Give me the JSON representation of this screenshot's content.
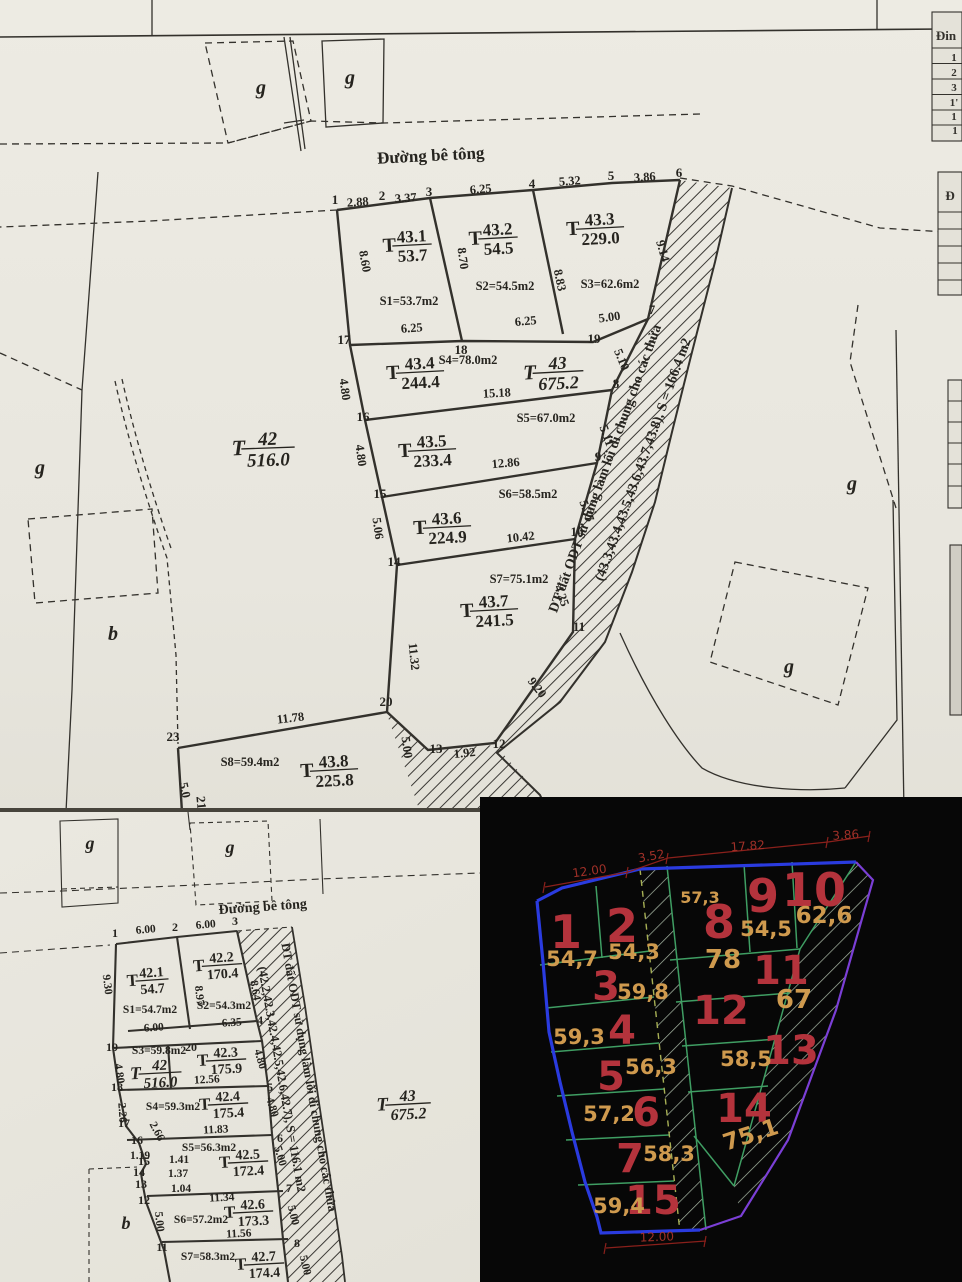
{
  "top_map": {
    "road": "Đường bê tông",
    "note1": "DT đất ODT sử dụng làm lối đi chung cho các thửa",
    "note2": "(43.3,43.4,43.5,43.6,43.7,43.8), S = 166.4 m2",
    "letters": [
      {
        "t": "g",
        "x": 261,
        "y": 94
      },
      {
        "t": "g",
        "x": 350,
        "y": 84
      },
      {
        "t": "g",
        "x": 40,
        "y": 474
      },
      {
        "t": "b",
        "x": 113,
        "y": 640
      },
      {
        "t": "g",
        "x": 852,
        "y": 490
      },
      {
        "t": "g",
        "x": 789,
        "y": 673
      }
    ],
    "vertices": [
      {
        "t": "1",
        "x": 335,
        "y": 204
      },
      {
        "t": "2",
        "x": 382,
        "y": 200
      },
      {
        "t": "3",
        "x": 429,
        "y": 196
      },
      {
        "t": "4",
        "x": 532,
        "y": 188
      },
      {
        "t": "5",
        "x": 611,
        "y": 180
      },
      {
        "t": "6",
        "x": 679,
        "y": 177
      },
      {
        "t": "7",
        "x": 652,
        "y": 314
      },
      {
        "t": "8",
        "x": 616,
        "y": 388
      },
      {
        "t": "9",
        "x": 598,
        "y": 461
      },
      {
        "t": "10",
        "x": 577,
        "y": 536
      },
      {
        "t": "11",
        "x": 579,
        "y": 631
      },
      {
        "t": "12",
        "x": 499,
        "y": 748
      },
      {
        "t": "13",
        "x": 436,
        "y": 753
      },
      {
        "t": "14",
        "x": 394,
        "y": 566
      },
      {
        "t": "15",
        "x": 380,
        "y": 498
      },
      {
        "t": "16",
        "x": 363,
        "y": 421
      },
      {
        "t": "17",
        "x": 344,
        "y": 344
      },
      {
        "t": "18",
        "x": 461,
        "y": 354
      },
      {
        "t": "19",
        "x": 594,
        "y": 343
      },
      {
        "t": "20",
        "x": 386,
        "y": 706
      },
      {
        "t": "23",
        "x": 173,
        "y": 741
      },
      {
        "t": "21",
        "x": 197,
        "y": 803,
        "r": 85
      }
    ],
    "dims": [
      {
        "t": "2.88",
        "x": 358,
        "y": 206,
        "r": -4
      },
      {
        "t": "3.37",
        "x": 406,
        "y": 202,
        "r": -4
      },
      {
        "t": "6.25",
        "x": 481,
        "y": 193,
        "r": -5
      },
      {
        "t": "5.32",
        "x": 570,
        "y": 185,
        "r": -4
      },
      {
        "t": "3.86",
        "x": 645,
        "y": 181,
        "r": -4
      },
      {
        "t": "8.60",
        "x": 361,
        "y": 262,
        "r": 80
      },
      {
        "t": "8.70",
        "x": 459,
        "y": 259,
        "r": 82
      },
      {
        "t": "8.83",
        "x": 556,
        "y": 281,
        "r": 78
      },
      {
        "t": "9.14",
        "x": 659,
        "y": 252,
        "r": 74
      },
      {
        "t": "6.25",
        "x": 412,
        "y": 332,
        "r": -4
      },
      {
        "t": "6.25",
        "x": 526,
        "y": 325,
        "r": -5
      },
      {
        "t": "5.00",
        "x": 610,
        "y": 321,
        "r": -8
      },
      {
        "t": "4.80",
        "x": 341,
        "y": 390,
        "r": 82
      },
      {
        "t": "15.18",
        "x": 497,
        "y": 397,
        "r": -3
      },
      {
        "t": "5.10",
        "x": 618,
        "y": 361,
        "r": 68
      },
      {
        "t": "4.80",
        "x": 357,
        "y": 456,
        "r": 82
      },
      {
        "t": "12.86",
        "x": 506,
        "y": 467,
        "r": -5
      },
      {
        "t": "5.11",
        "x": 603,
        "y": 437,
        "r": 70
      },
      {
        "t": "5.06",
        "x": 374,
        "y": 529,
        "r": 82
      },
      {
        "t": "10.42",
        "x": 521,
        "y": 541,
        "r": -6
      },
      {
        "t": "5.37",
        "x": 583,
        "y": 512,
        "r": 70
      },
      {
        "t": "11.32",
        "x": 410,
        "y": 657,
        "r": 84
      },
      {
        "t": "4.25",
        "x": 558,
        "y": 597,
        "r": 70
      },
      {
        "t": "9.20",
        "x": 534,
        "y": 690,
        "r": 52
      },
      {
        "t": "11.78",
        "x": 291,
        "y": 722,
        "r": -7
      },
      {
        "t": "5.0",
        "x": 181,
        "y": 791,
        "r": 78
      },
      {
        "t": "5.00",
        "x": 403,
        "y": 748,
        "r": 82
      },
      {
        "t": "1.92",
        "x": 465,
        "y": 757,
        "r": -6
      }
    ],
    "areas": [
      {
        "t": "S1=53.7m2",
        "x": 409,
        "y": 305
      },
      {
        "t": "S2=54.5m2",
        "x": 505,
        "y": 290
      },
      {
        "t": "S3=62.6m2",
        "x": 610,
        "y": 288
      },
      {
        "t": "S4=78.0m2",
        "x": 468,
        "y": 364
      },
      {
        "t": "S5=67.0m2",
        "x": 546,
        "y": 422
      },
      {
        "t": "S6=58.5m2",
        "x": 528,
        "y": 498
      },
      {
        "t": "S7=75.1m2",
        "x": 519,
        "y": 583
      },
      {
        "t": "S8=59.4m2",
        "x": 250,
        "y": 766
      }
    ],
    "fracs": [
      {
        "pre": "T",
        "top": "43.1",
        "bot": "53.7",
        "x": 412,
        "y": 245,
        "s": 17,
        "r": -3
      },
      {
        "pre": "T",
        "top": "43.2",
        "bot": "54.5",
        "x": 498,
        "y": 238,
        "s": 17,
        "r": -3
      },
      {
        "pre": "T",
        "top": "43.3",
        "bot": "229.0",
        "x": 600,
        "y": 228,
        "s": 17,
        "r": -3
      },
      {
        "pre": "T",
        "top": "43.4",
        "bot": "244.4",
        "x": 420,
        "y": 372,
        "s": 17,
        "r": -3
      },
      {
        "pre": "T",
        "top": "43",
        "bot": "675.2",
        "x": 558,
        "y": 372,
        "s": 18,
        "r": -3,
        "i": 1
      },
      {
        "pre": "T",
        "top": "43.5",
        "bot": "233.4",
        "x": 432,
        "y": 450,
        "s": 17,
        "r": -3
      },
      {
        "pre": "T",
        "top": "43.6",
        "bot": "224.9",
        "x": 447,
        "y": 527,
        "s": 17,
        "r": -3
      },
      {
        "pre": "T",
        "top": "43.7",
        "bot": "241.5",
        "x": 494,
        "y": 610,
        "s": 17,
        "r": -3
      },
      {
        "pre": "T",
        "top": "43.8",
        "bot": "225.8",
        "x": 334,
        "y": 770,
        "s": 17,
        "r": -3
      },
      {
        "pre": "T",
        "top": "42",
        "bot": "516.0",
        "x": 268,
        "y": 448,
        "s": 19,
        "r": -2,
        "i": 1
      }
    ]
  },
  "bottom_map": {
    "road": "Đường bê tông",
    "note1": "DT đất ODT sử dụng làm lối đi chung cho các thửa",
    "note2": "(42.2,42.3,42.4,42.5,42.6,42.7), S = 116.1 m2",
    "letters": [
      {
        "t": "g",
        "x": 90,
        "y": 849,
        "s": 18
      },
      {
        "t": "g",
        "x": 230,
        "y": 853,
        "s": 18
      },
      {
        "t": "b",
        "x": 126,
        "y": 1229,
        "s": 18
      }
    ],
    "vertices": [
      {
        "t": "1",
        "x": 115,
        "y": 937
      },
      {
        "t": "2",
        "x": 175,
        "y": 931
      },
      {
        "t": "3",
        "x": 235,
        "y": 925
      },
      {
        "t": "4",
        "x": 260,
        "y": 1024
      },
      {
        "t": "19",
        "x": 112,
        "y": 1051
      },
      {
        "t": "20",
        "x": 191,
        "y": 1051
      },
      {
        "t": "18",
        "x": 117,
        "y": 1091
      },
      {
        "t": "5",
        "x": 270,
        "y": 1091
      },
      {
        "t": "17",
        "x": 124,
        "y": 1127
      },
      {
        "t": "16",
        "x": 137,
        "y": 1144
      },
      {
        "t": "15",
        "x": 144,
        "y": 1165
      },
      {
        "t": "6",
        "x": 280,
        "y": 1142
      },
      {
        "t": "14",
        "x": 139,
        "y": 1176
      },
      {
        "t": "13",
        "x": 141,
        "y": 1188
      },
      {
        "t": "12",
        "x": 144,
        "y": 1204
      },
      {
        "t": "7",
        "x": 289,
        "y": 1192
      },
      {
        "t": "11",
        "x": 162,
        "y": 1251
      },
      {
        "t": "8",
        "x": 297,
        "y": 1247
      }
    ],
    "dims": [
      {
        "t": "6.00",
        "x": 146,
        "y": 933,
        "r": -5
      },
      {
        "t": "6.00",
        "x": 206,
        "y": 928,
        "r": -5
      },
      {
        "t": "9.30",
        "x": 104,
        "y": 985,
        "r": 83
      },
      {
        "t": "8.97",
        "x": 196,
        "y": 996,
        "r": 84
      },
      {
        "t": "8.64",
        "x": 252,
        "y": 991,
        "r": 80
      },
      {
        "t": "6.00",
        "x": 154,
        "y": 1031,
        "r": -4
      },
      {
        "t": "6.35",
        "x": 232,
        "y": 1026,
        "r": -4
      },
      {
        "t": "4.80",
        "x": 116,
        "y": 1074,
        "r": 82
      },
      {
        "t": "12.56",
        "x": 207,
        "y": 1083,
        "r": -3
      },
      {
        "t": "4.80",
        "x": 257,
        "y": 1060,
        "r": 74
      },
      {
        "t": "2.26",
        "x": 119,
        "y": 1113,
        "r": 86
      },
      {
        "t": "11.83",
        "x": 216,
        "y": 1133,
        "r": -3
      },
      {
        "t": "4.80",
        "x": 269,
        "y": 1108,
        "r": 74
      },
      {
        "t": "2.66",
        "x": 154,
        "y": 1133,
        "r": 62
      },
      {
        "t": "1.19",
        "x": 140,
        "y": 1159
      },
      {
        "t": "1.41",
        "x": 179,
        "y": 1163
      },
      {
        "t": "5.00",
        "x": 277,
        "y": 1157,
        "r": 74
      },
      {
        "t": "1.37",
        "x": 178,
        "y": 1177
      },
      {
        "t": "1.04",
        "x": 181,
        "y": 1192
      },
      {
        "t": "11.34",
        "x": 222,
        "y": 1201,
        "r": -3
      },
      {
        "t": "5.00",
        "x": 290,
        "y": 1216,
        "r": 76
      },
      {
        "t": "11.56",
        "x": 239,
        "y": 1237,
        "r": -3
      },
      {
        "t": "5.00",
        "x": 156,
        "y": 1222,
        "r": 84
      },
      {
        "t": "5.00",
        "x": 302,
        "y": 1266,
        "r": 76
      }
    ],
    "areas": [
      {
        "t": "S1=54.7m2",
        "x": 150,
        "y": 1013
      },
      {
        "t": "S2=54.3m2",
        "x": 224,
        "y": 1009
      },
      {
        "t": "S3=59.8m2",
        "x": 159,
        "y": 1054
      },
      {
        "t": "S4=59.3m2",
        "x": 173,
        "y": 1110
      },
      {
        "t": "S5=56.3m2",
        "x": 209,
        "y": 1151
      },
      {
        "t": "S6=57.2m2",
        "x": 201,
        "y": 1223
      },
      {
        "t": "S7=58.3m2",
        "x": 208,
        "y": 1260
      }
    ],
    "fracs": [
      {
        "pre": "T",
        "top": "42.1",
        "bot": "54.7",
        "x": 152,
        "y": 980,
        "s": 14,
        "r": -4
      },
      {
        "pre": "T",
        "top": "42.2",
        "bot": "170.4",
        "x": 222,
        "y": 965,
        "s": 14,
        "r": -4
      },
      {
        "pre": "T",
        "top": "42.3",
        "bot": "175.9",
        "x": 226,
        "y": 1060,
        "s": 14,
        "r": -3
      },
      {
        "pre": "T",
        "top": "42",
        "bot": "516.0",
        "x": 160,
        "y": 1073,
        "s": 15,
        "r": -3,
        "i": 1
      },
      {
        "pre": "T",
        "top": "42.4",
        "bot": "175.4",
        "x": 228,
        "y": 1104,
        "s": 14,
        "r": -3
      },
      {
        "pre": "T",
        "top": "42.5",
        "bot": "172.4",
        "x": 248,
        "y": 1162,
        "s": 14,
        "r": -3
      },
      {
        "pre": "T",
        "top": "42.6",
        "bot": "173.3",
        "x": 253,
        "y": 1212,
        "s": 14,
        "r": -3
      },
      {
        "pre": "T",
        "top": "42.7",
        "bot": "174.4",
        "x": 264,
        "y": 1264,
        "s": 14,
        "r": -3
      },
      {
        "pre": "T",
        "top": "43",
        "bot": "675.2",
        "x": 408,
        "y": 1104,
        "s": 16,
        "r": -3,
        "i": 1
      }
    ]
  },
  "cad": {
    "numbers": [
      {
        "t": "1",
        "x": 566,
        "y": 948,
        "s": 46
      },
      {
        "t": "2",
        "x": 622,
        "y": 942,
        "s": 46
      },
      {
        "t": "3",
        "x": 606,
        "y": 1000
      },
      {
        "t": "4",
        "x": 622,
        "y": 1044
      },
      {
        "t": "5",
        "x": 611,
        "y": 1090
      },
      {
        "t": "6",
        "x": 646,
        "y": 1126
      },
      {
        "t": "7",
        "x": 630,
        "y": 1172
      },
      {
        "t": "15",
        "x": 653,
        "y": 1214
      },
      {
        "t": "8",
        "x": 719,
        "y": 938,
        "s": 46
      },
      {
        "t": "9",
        "x": 763,
        "y": 912,
        "s": 46
      },
      {
        "t": "10",
        "x": 814,
        "y": 906,
        "s": 46
      },
      {
        "t": "11",
        "x": 781,
        "y": 984
      },
      {
        "t": "12",
        "x": 721,
        "y": 1024
      },
      {
        "t": "13",
        "x": 791,
        "y": 1064
      },
      {
        "t": "14",
        "x": 744,
        "y": 1122
      }
    ],
    "areas": [
      {
        "t": "54,7",
        "x": 572,
        "y": 966
      },
      {
        "t": "54,3",
        "x": 634,
        "y": 959
      },
      {
        "t": "59,8",
        "x": 643,
        "y": 999
      },
      {
        "t": "59,3",
        "x": 579,
        "y": 1044
      },
      {
        "t": "56,3",
        "x": 651,
        "y": 1074
      },
      {
        "t": "57,2",
        "x": 609,
        "y": 1121
      },
      {
        "t": "58,3",
        "x": 669,
        "y": 1161
      },
      {
        "t": "59,4",
        "x": 619,
        "y": 1213
      },
      {
        "t": "57,3",
        "x": 700,
        "y": 903,
        "s": 16
      },
      {
        "t": "54,5",
        "x": 766,
        "y": 936
      },
      {
        "t": "62,6",
        "x": 824,
        "y": 923,
        "s": 23
      },
      {
        "t": "78",
        "x": 723,
        "y": 968,
        "s": 26
      },
      {
        "t": "67",
        "x": 794,
        "y": 1008,
        "s": 26
      },
      {
        "t": "58,5",
        "x": 746,
        "y": 1066
      },
      {
        "t": "75,1",
        "x": 753,
        "y": 1142,
        "s": 23,
        "r": -18
      }
    ],
    "dims": [
      {
        "t": "12.00",
        "x": 590,
        "y": 875,
        "r": -8
      },
      {
        "t": "3.52",
        "x": 652,
        "y": 860,
        "r": -10
      },
      {
        "t": "17.82",
        "x": 748,
        "y": 850,
        "r": -4
      },
      {
        "t": "3.86",
        "x": 846,
        "y": 839,
        "r": -4
      },
      {
        "t": "12.00",
        "x": 657,
        "y": 1241,
        "r": -2
      }
    ],
    "colors": {
      "outline_left": "#2a3bdf",
      "outline_right": "#7b3fd6",
      "grid": "#3f9e63",
      "number": "#b4333c",
      "area": "#cf9a4e",
      "dimension": "#a03028"
    }
  },
  "side_tables": {
    "labels": [
      {
        "t": "Đin",
        "x": 946,
        "y": 40,
        "s": 13
      },
      {
        "t": "1",
        "x": 954,
        "y": 61
      },
      {
        "t": "2",
        "x": 954,
        "y": 76
      },
      {
        "t": "3",
        "x": 954,
        "y": 91
      },
      {
        "t": "1'",
        "x": 954,
        "y": 106
      },
      {
        "t": "1",
        "x": 954,
        "y": 120
      },
      {
        "t": "1",
        "x": 955,
        "y": 134
      },
      {
        "t": "Đ",
        "x": 950,
        "y": 200,
        "s": 13
      }
    ]
  }
}
